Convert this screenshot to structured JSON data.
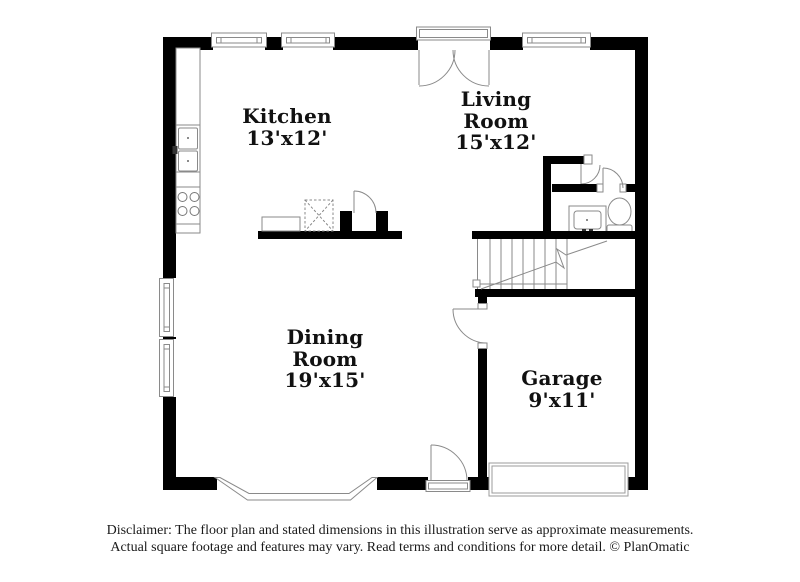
{
  "rooms": {
    "kitchen": {
      "label": "Kitchen",
      "dims": "13'x12'"
    },
    "living": {
      "line1": "Living",
      "line2": "Room",
      "dims": "15'x12'"
    },
    "dining": {
      "line1": "Dining",
      "line2": "Room",
      "dims": "19'x15'"
    },
    "garage": {
      "label": "Garage",
      "dims": "9'x11'"
    }
  },
  "disclaimer": {
    "line1": "Disclaimer: The floor plan and stated dimensions in this illustration serve as approximate measurements.",
    "line2": "Actual square footage and features may vary. Read terms and conditions for more detail. © PlanOmatic"
  },
  "colors": {
    "wall": "#000000",
    "fixture_line": "#8a8a8a",
    "background": "#ffffff",
    "text": "#1a1a1a"
  },
  "branding": {
    "source": "PlanOmatic"
  }
}
